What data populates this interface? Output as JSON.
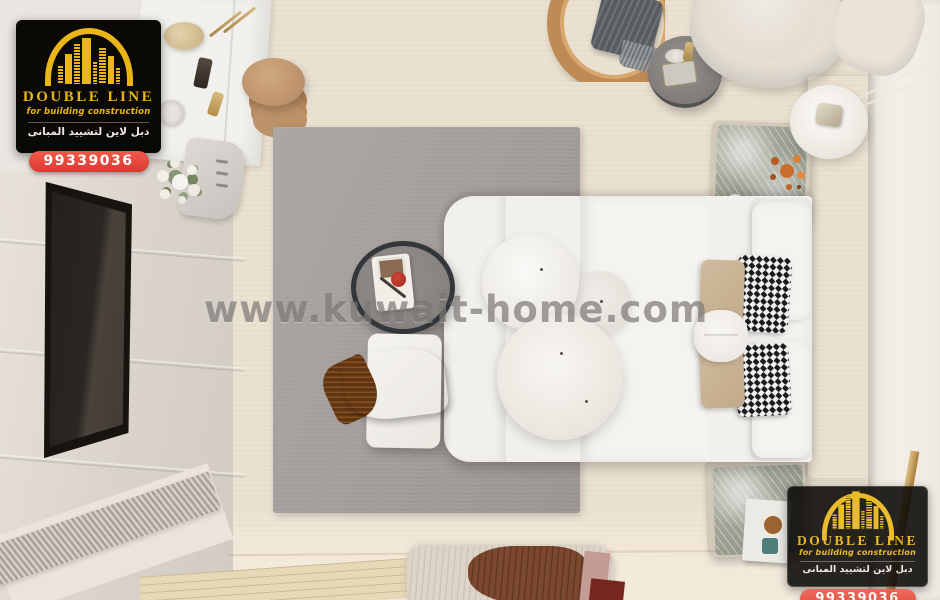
{
  "watermark": {
    "text": "www.kuwait-home.com",
    "color": "#64615E"
  },
  "logo": {
    "brand_name": "DOUBLE LINE",
    "tagline": "for building construction",
    "tagline_arabic": "دبل لاين لتشييد المبانى",
    "phone": "99339036",
    "colors": {
      "gold": "#EAB615",
      "box_background": "#0B0906",
      "phone_pill": "#E8473C",
      "phone_text": "#FFFFFF"
    }
  },
  "scene": {
    "type": "top-down 3D interior render of a modern bedroom",
    "palette": {
      "floor_beige": "#EBE1D1",
      "area_rug_gray": "#A29C9A",
      "bedding_white": "#F3F1ED",
      "runner_tan": "#C0A988",
      "headboard_beige": "#D2C7B7",
      "left_wall_greige": "#DAD3CC",
      "wood_tan": "#BF8B55",
      "throw_rust": "#A8641F",
      "mirror_dark": "#241F1C",
      "marble_gray_green": "#9AA093"
    },
    "objects": [
      "bed with white bedding and tan throw runner",
      "white and beige pillows with two black-white houndstooth accent pillows",
      "three round white pendant lamps above the bed",
      "gray area rug",
      "white bench with rust-brown throw blanket",
      "round side table with black rim and white serving tray",
      "full-length dark leaning mirror",
      "white dresser with perfume decor and white flower arrangement",
      "stack of tan floor poufs",
      "round wood hanging chair with dark knit throw",
      "round gray decor table with vase and tray",
      "cream armchair",
      "two marble-top nightstands",
      "orange flower arrangement on nightstand",
      "white disc lamp with brass arm and wires",
      "wavy cream-and-brown bedside rug",
      "slatted wall panels",
      "light wood floor strip"
    ]
  }
}
